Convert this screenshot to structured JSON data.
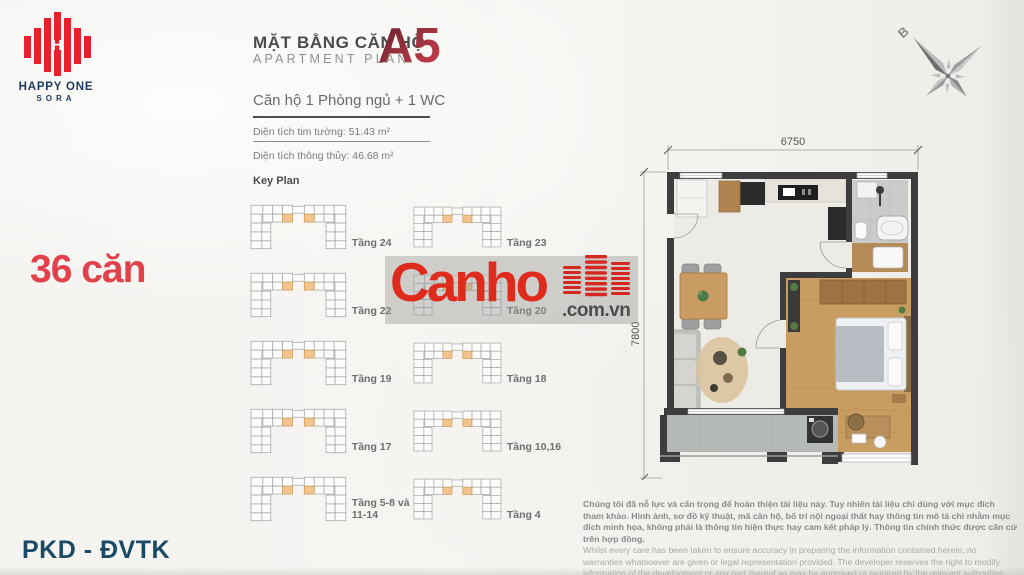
{
  "logo": {
    "title": "HAPPY ONE",
    "subtitle": "SORA"
  },
  "left": {
    "units_count": "36 căn",
    "footer": "PKD - ĐVTK"
  },
  "header": {
    "title_vi": "MẶT BẰNG CĂN HỘ",
    "title_en": "APARTMENT  PLAN",
    "unit_code": "A5",
    "unit_type": "Căn hộ 1 Phòng ngủ + 1 WC",
    "area_wall": "Diện tích tim tường: 51.43 m²",
    "area_net": "Diện tích thông thủy: 46.68 m²"
  },
  "keyplan": {
    "title": "Key Plan",
    "items": [
      {
        "label": "Tầng 24"
      },
      {
        "label": "Tầng 23"
      },
      {
        "label": "Tầng 22"
      },
      {
        "label": "Tầng 20"
      },
      {
        "label": "Tầng 19"
      },
      {
        "label": "Tầng 18"
      },
      {
        "label": "Tầng 17"
      },
      {
        "label": "Tầng 10,16"
      },
      {
        "label": "Tầng 5-8 và 11-14"
      },
      {
        "label": "Tầng 4"
      }
    ]
  },
  "floorplan": {
    "dim_width": "6750",
    "dim_height": "7800",
    "compass_label": "B"
  },
  "watermark": {
    "brand": "Canho",
    "domain": ".com.vn"
  },
  "disclaimer": {
    "vi": "Chúng tôi đã nỗ lực và cẩn trọng để hoàn thiện tài liệu này. Tuy nhiên tài liệu chỉ dùng với mục đích tham khảo. Hình ảnh, sơ đồ kỹ thuật, mã căn hộ, bố trí nội ngoại thất hay thông tin mô tả chỉ nhằm mục đích minh họa, không phải là thông tin hiện thực hay cam kết pháp lý. Thông tin chính thức được căn cứ trên hợp đồng.",
    "en": "Whilst every care has been taken to ensure accuracy in preparing the information contained herein, no warranties whatsoever are given or legal representation provided. The developer reserves the right to modify information of the development or any part thereof as may be approved or required by the relevant authorities."
  },
  "colors": {
    "accent_red": "#df2a1e",
    "brand_navy": "#1c3a5e",
    "code_red_dark": "#6e2530",
    "code_red_light": "#c93c49",
    "keyplan_highlight": "#f3c48f",
    "wall": "#3d3d3d",
    "wood_floor": "#c79d62",
    "balcony_floor": "#b5b9b5"
  }
}
